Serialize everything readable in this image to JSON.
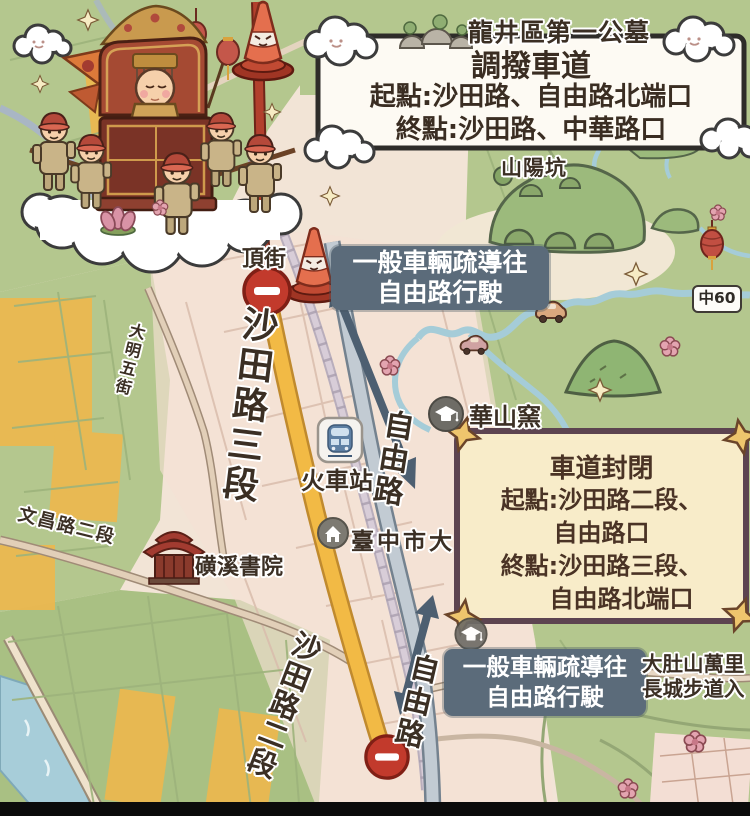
{
  "header": {
    "cemetery": "龍井區第一公墓"
  },
  "route_box": {
    "title": "調撥車道",
    "line1": "起點:沙田路、自由路北端口",
    "line2": "終點:沙田路、中華路口"
  },
  "closure_box": {
    "title": "車道封閉",
    "line1": "起點:沙田路二段、",
    "line2": "自由路口",
    "line3": "終點:沙田路三段、",
    "line4": "自由路北端口"
  },
  "diversion_north": {
    "line1": "一般車輛疏導往",
    "line2": "自由路行駛"
  },
  "diversion_south": {
    "line1": "一般車輛疏導往",
    "line2": "自由路行駛"
  },
  "roads": {
    "shatian3": "沙田路三段",
    "shatian2": "沙田路二段",
    "ziyou_north": "自由路",
    "ziyou_south": "自由路",
    "daming": "大明五街",
    "wenchang": "文昌路二段",
    "badge": "中60"
  },
  "places": {
    "top_street": "頂街",
    "train_station": "火車站",
    "taichung_uni": "臺中市大",
    "huashan_kiln": "華山窯",
    "shanyang": "山陽坑",
    "huangxi_academy": "磺溪書院",
    "dadushan_line1": "大肚山萬里",
    "dadushan_line2": "長城步道入"
  },
  "colors": {
    "map_green": "#b4c78e",
    "map_cream": "#f2e4d6",
    "road_yellow": "#f2ba45",
    "road_closed_red": "#b2402d",
    "road_gray": "#c2cbd3",
    "sign_red": "#c23a2c",
    "label_bg": "#5b6b7a",
    "closure_box_fill": "#f8ecc9",
    "closure_box_border": "#5d4450",
    "arrow": "#4d5f71"
  },
  "icons": {
    "no_entry": "red circle white bar",
    "traffic_cone": "orange cone with face",
    "train_station": "train in rounded square",
    "school": "gray circle mortarboard",
    "landmark": "gray circle house",
    "temple": "red temple building",
    "tombs": "gray grave mounds",
    "cloud": "white smiling cloud",
    "lantern": "red lantern",
    "deity_procession": "Mazu palanquin with bearers on cloud"
  }
}
